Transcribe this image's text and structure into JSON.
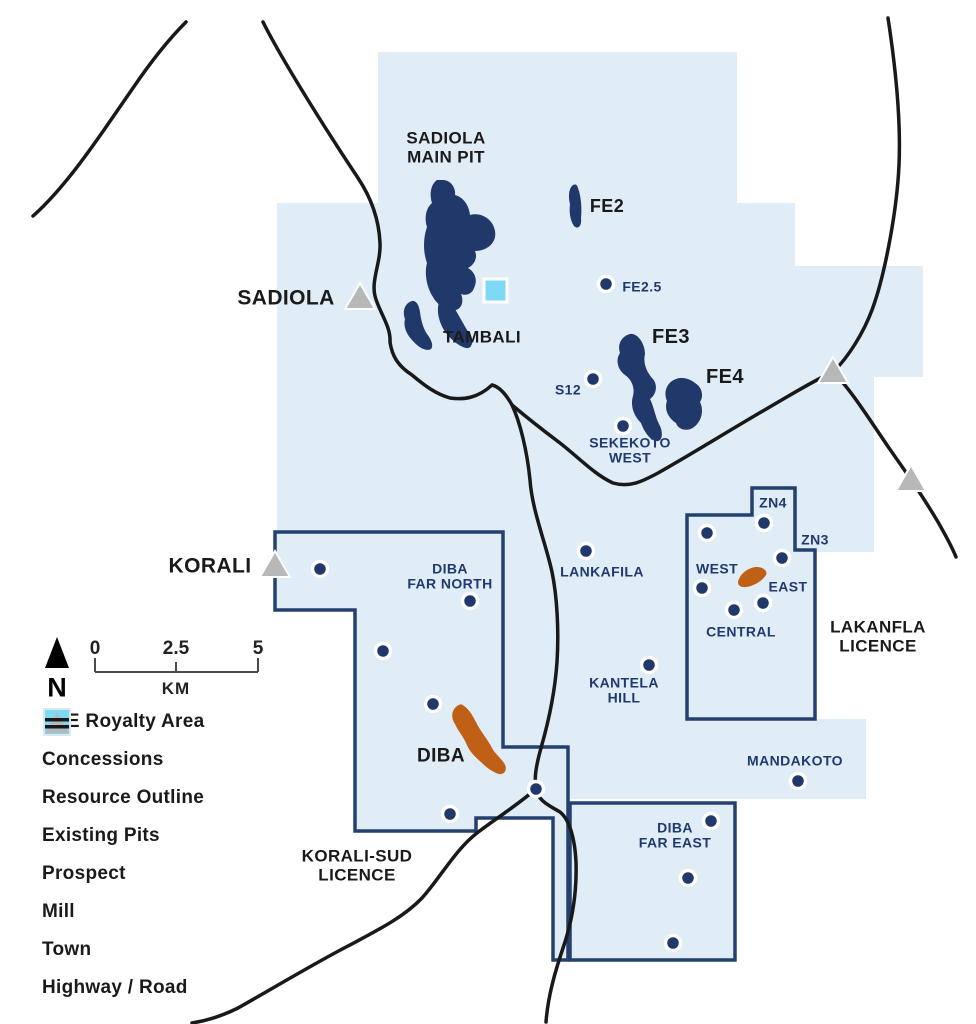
{
  "map_title": "Sadiola area licence and prospect map",
  "colors": {
    "concession": "#e0ecf6",
    "royalty_outline": "#24406e",
    "pit": "#21386b",
    "prospect_dot": "#21386b",
    "prospect_label": "#1f3a70",
    "resource": "#c05f16",
    "mill": "#7edaf4",
    "town": "#b7b8ba",
    "road": "#191919"
  },
  "pits": [
    {
      "name": "SADIOLA MAIN PIT",
      "label_lines": [
        "SADIOLA",
        "MAIN PIT"
      ],
      "x": 446,
      "y": 148,
      "size": 17
    },
    {
      "name": "FE2",
      "label_lines": [
        "FE2"
      ],
      "x": 607,
      "y": 207,
      "size": 18
    },
    {
      "name": "TAMBALI",
      "label_lines": [
        "TAMBALI"
      ],
      "x": 482,
      "y": 338,
      "size": 17
    },
    {
      "name": "FE3",
      "label_lines": [
        "FE3"
      ],
      "x": 671,
      "y": 337,
      "size": 20
    },
    {
      "name": "FE4",
      "label_lines": [
        "FE4"
      ],
      "x": 725,
      "y": 377,
      "size": 20
    }
  ],
  "resource_outlines": [
    {
      "name": "DIBA",
      "label_lines": [
        "DIBA"
      ],
      "x": 441,
      "y": 757,
      "size": 19
    }
  ],
  "licences": [
    {
      "name": "LAKANFLA LICENCE",
      "label_lines": [
        "LAKANFLA",
        "LICENCE"
      ],
      "x": 878,
      "y": 637,
      "size": 17
    },
    {
      "name": "KORALI-SUD LICENCE",
      "label_lines": [
        "KORALI-SUD",
        "LICENCE"
      ],
      "x": 357,
      "y": 866,
      "size": 17
    }
  ],
  "towns": [
    {
      "name": "SADIOLA",
      "x": 360,
      "y": 298,
      "label": {
        "lines": [
          "SADIOLA"
        ],
        "x": 286,
        "y": 298,
        "size": 21
      }
    },
    {
      "name": "KORALI",
      "x": 275,
      "y": 566,
      "label": {
        "lines": [
          "KORALI"
        ],
        "x": 210,
        "y": 566,
        "size": 21
      }
    },
    {
      "name": "",
      "x": 833,
      "y": 372,
      "label": null
    },
    {
      "name": "",
      "x": 911,
      "y": 480,
      "label": null
    }
  ],
  "prospects": [
    {
      "name": "FE2.5",
      "x": 606,
      "y": 284,
      "label": {
        "lines": [
          "FE2.5"
        ],
        "x": 642,
        "y": 287
      }
    },
    {
      "name": "S12",
      "x": 593,
      "y": 379,
      "label": {
        "lines": [
          "S12"
        ],
        "x": 568,
        "y": 390
      }
    },
    {
      "name": "SEKEKOTO WEST",
      "x": 623,
      "y": 426,
      "label": {
        "lines": [
          "SEKEKOTO",
          "WEST"
        ],
        "x": 630,
        "y": 451
      }
    },
    {
      "name": "LANKAFILA",
      "x": 586,
      "y": 551,
      "label": {
        "lines": [
          "LANKAFILA"
        ],
        "x": 602,
        "y": 572
      }
    },
    {
      "name": "KANTELA HILL",
      "x": 649,
      "y": 665,
      "label": {
        "lines": [
          "KANTELA",
          "HILL"
        ],
        "x": 624,
        "y": 691
      }
    },
    {
      "name": "DIBA FAR NORTH",
      "x": 470,
      "y": 601,
      "label": {
        "lines": [
          "DIBA",
          "FAR NORTH"
        ],
        "x": 450,
        "y": 577
      }
    },
    {
      "name": "",
      "x": 320,
      "y": 569,
      "label": null
    },
    {
      "name": "",
      "x": 383,
      "y": 651,
      "label": null
    },
    {
      "name": "",
      "x": 433,
      "y": 704,
      "label": null
    },
    {
      "name": "",
      "x": 450,
      "y": 814,
      "label": null
    },
    {
      "name": "",
      "x": 536,
      "y": 789,
      "label": null
    },
    {
      "name": "ZN4",
      "x": 764,
      "y": 523,
      "label": {
        "lines": [
          "ZN4"
        ],
        "x": 773,
        "y": 503
      }
    },
    {
      "name": "",
      "x": 707,
      "y": 533,
      "label": null
    },
    {
      "name": "ZN3",
      "x": 782,
      "y": 558,
      "label": {
        "lines": [
          "ZN3"
        ],
        "x": 815,
        "y": 540
      }
    },
    {
      "name": "WEST",
      "x": 702,
      "y": 588,
      "label": {
        "lines": [
          "WEST"
        ],
        "x": 717,
        "y": 569
      }
    },
    {
      "name": "EAST",
      "x": 763,
      "y": 603,
      "label": {
        "lines": [
          "EAST"
        ],
        "x": 788,
        "y": 587
      }
    },
    {
      "name": "CENTRAL",
      "x": 734,
      "y": 610,
      "label": {
        "lines": [
          "CENTRAL"
        ],
        "x": 741,
        "y": 632
      }
    },
    {
      "name": "MANDAKOTO",
      "x": 798,
      "y": 781,
      "label": {
        "lines": [
          "MANDAKOTO"
        ],
        "x": 795,
        "y": 761
      }
    },
    {
      "name": "DIBA FAR EAST",
      "x": 711,
      "y": 821,
      "label": {
        "lines": [
          "DIBA",
          "FAR EAST"
        ],
        "x": 675,
        "y": 836
      }
    },
    {
      "name": "",
      "x": 688,
      "y": 878,
      "label": null
    },
    {
      "name": "",
      "x": 673,
      "y": 943,
      "label": null
    }
  ],
  "mill": {
    "x": 484,
    "y": 279,
    "size": 23
  },
  "legend": {
    "items": [
      {
        "label": "ELE Royalty Area",
        "swatch": "royalty"
      },
      {
        "label": "Concessions",
        "swatch": "concession"
      },
      {
        "label": "Resource Outline",
        "swatch": "resource"
      },
      {
        "label": "Existing Pits",
        "swatch": "pit"
      },
      {
        "label": "Prospect",
        "swatch": "prospect"
      },
      {
        "label": "Mill",
        "swatch": "mill"
      },
      {
        "label": "Town",
        "swatch": "town"
      },
      {
        "label": "Highway / Road",
        "swatch": "road"
      }
    ]
  },
  "scale": {
    "north_label": "N",
    "ticks": [
      "0",
      "2.5",
      "5"
    ],
    "unit": "KM"
  }
}
